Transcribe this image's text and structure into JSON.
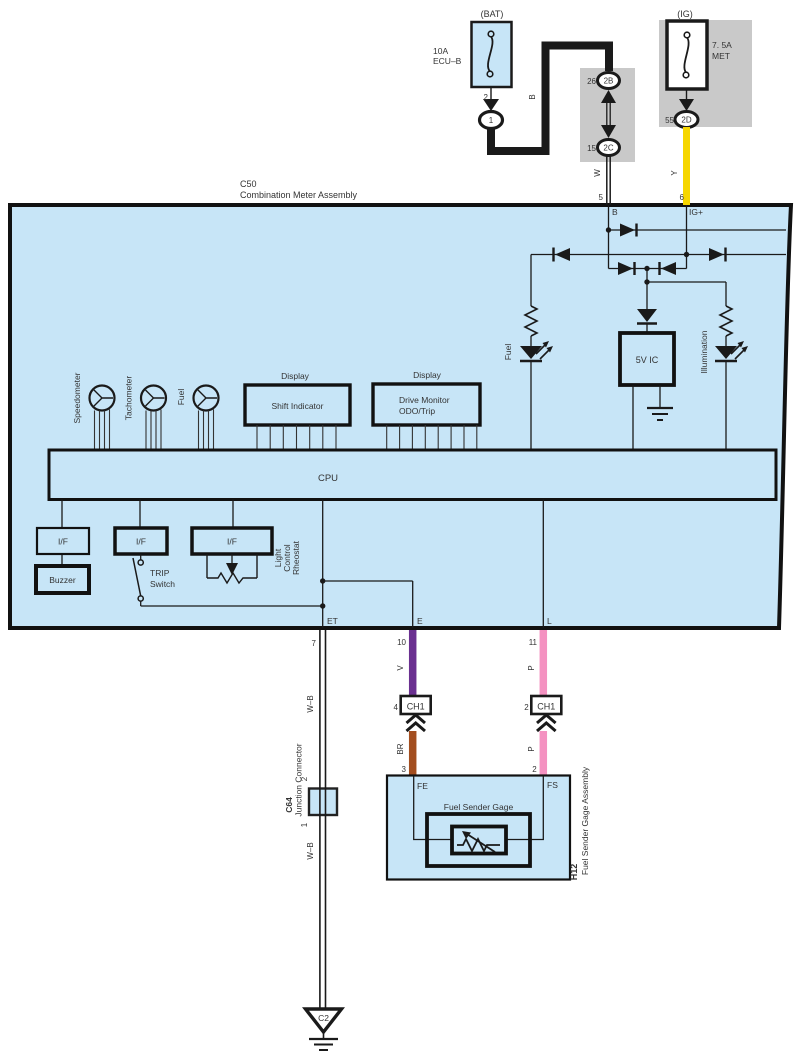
{
  "colors": {
    "panel_blue": "#c7e5f7",
    "connector_gray": "#c9c9c9",
    "wire_black": "#1a1a1a",
    "wire_yellow": "#f6d600",
    "wire_violet": "#6a3090",
    "wire_pink": "#f492c1",
    "wire_brown": "#a34e1f"
  },
  "power": {
    "bat": {
      "title": "(BAT)",
      "rating": "10A",
      "circuit": "ECU–B",
      "pin": "2",
      "connector": "1",
      "wire": "B"
    },
    "ig": {
      "title": "(IG)",
      "rating": "7. 5A",
      "circuit": "MET",
      "pin": "55",
      "connector": "2D",
      "wire": "Y"
    },
    "j2b": {
      "pin": "26",
      "label": "2B"
    },
    "j2c": {
      "pin": "15",
      "label": "2C",
      "wire": "W"
    },
    "pin5": "5",
    "pin6": "6"
  },
  "c50": {
    "code": "C50",
    "name": "Combination Meter Assembly",
    "pin_b": "B",
    "pin_ig": "IG+",
    "gauges": [
      "Speedometer",
      "Tachometer",
      "Fuel"
    ],
    "display_title": "Display",
    "display1": "Shift Indicator",
    "display2_line1": "Drive Monitor",
    "display2_line2": "ODO/Trip",
    "cpu": "CPU",
    "ic": "5V IC",
    "led_fuel": "Fuel",
    "led_illum": "Illumination",
    "if_label": "I/F",
    "buzzer": "Buzzer",
    "trip1": "TRIP",
    "trip2": "Switch",
    "rheo1": "Light",
    "rheo2": "Control",
    "rheo3": "Rheostat",
    "pin_et": "ET",
    "pin_e": "E",
    "pin_l": "L"
  },
  "harness": {
    "pin7": "7",
    "wire_wb": "W–B",
    "wire_wb2": "W–B",
    "pin10": "10",
    "wire_v": "V",
    "pin11": "11",
    "wire_p": "P",
    "ch1a_pin": "4",
    "ch1a": "CH1",
    "ch1b_pin": "2",
    "ch1b": "CH1",
    "wire_br": "BR",
    "pin3": "3",
    "wire_p2": "P",
    "pin2": "2"
  },
  "c64": {
    "code": "C64",
    "name": "Junction Connector",
    "pin_top": "2",
    "pin_bottom": "1"
  },
  "sender": {
    "code": "H12",
    "name": "Fuel Sender Gage Assembly",
    "gage": "Fuel Sender Gage",
    "pin_fe": "FE",
    "pin_fs": "FS"
  },
  "ground": {
    "label": "C2"
  }
}
